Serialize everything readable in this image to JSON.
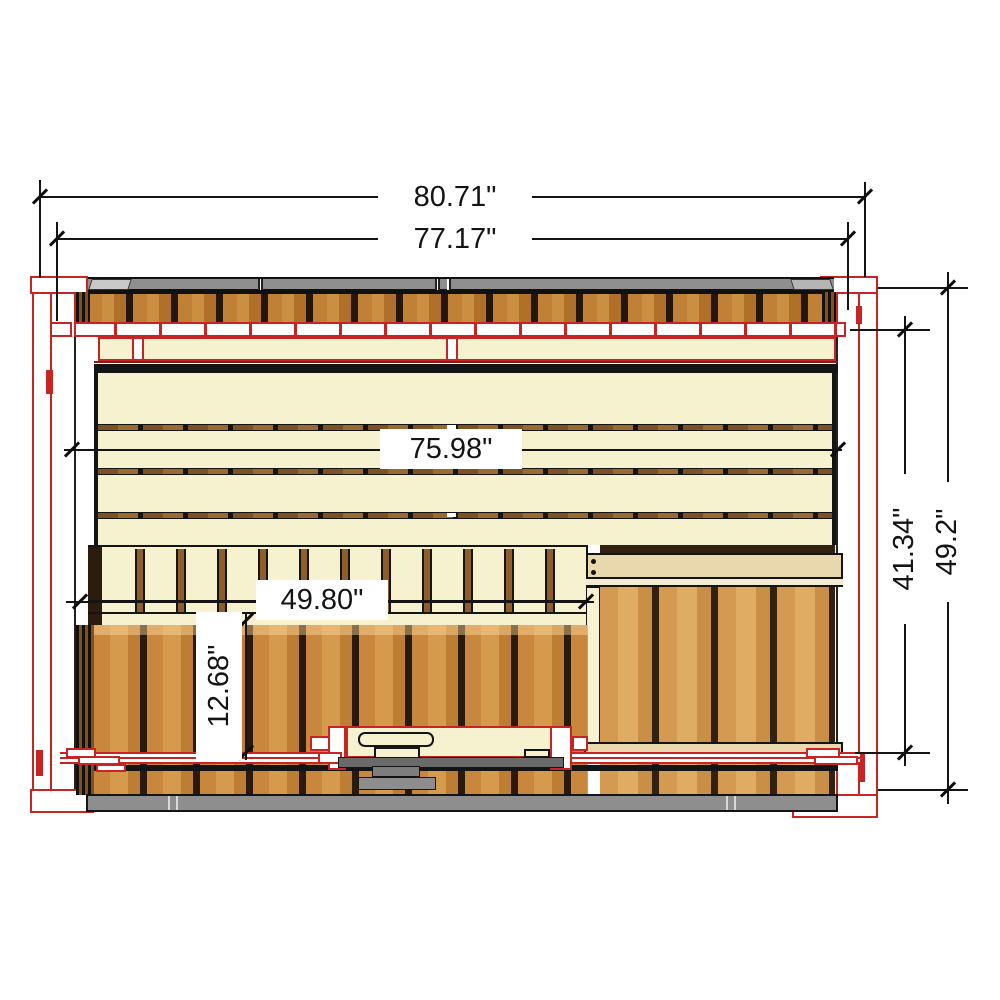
{
  "drawing": {
    "title": "sauna-top-view-dimension-drawing",
    "dimensions": {
      "top_outer": "80.71\"",
      "top_inner": "77.17\"",
      "bench_width": "75.98\"",
      "front_bench_width": "49.80\"",
      "bench_depth": "12.68\"",
      "side_inner": "41.34\"",
      "side_outer": "49.2\""
    },
    "colors": {
      "outline_red": "#c92424",
      "wood_cream": "#f6f2cf",
      "wood_plank": "#c8873c",
      "wood_gap_dark": "#2a1a0c",
      "roof_gray": "#8f8f8f",
      "board_beige": "#e9d7ae",
      "line_black": "#141414"
    }
  }
}
